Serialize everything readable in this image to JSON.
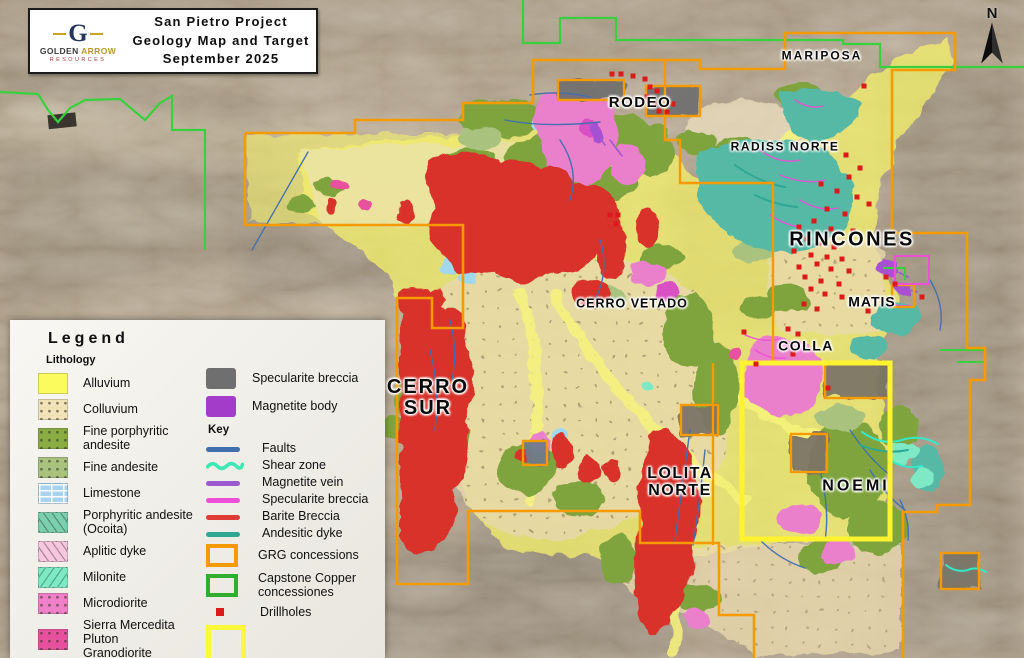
{
  "title_box": {
    "line1": "San Pietro Project",
    "line2": "Geology Map and Target",
    "line3": "September 2025"
  },
  "logo": {
    "monogram": "G",
    "golden": "GOLDEN",
    "arrow": "ARROW",
    "resources": "RESOURCES"
  },
  "north_indicator": {
    "label": "N"
  },
  "legend": {
    "title": "Legend",
    "lithology_heading": "Lithology",
    "lithology": [
      {
        "label": "Alluvium",
        "color": "#fbfb5e",
        "pattern": "solid"
      },
      {
        "label": "Colluvium",
        "color": "#f2e3b9",
        "pattern": "dots"
      },
      {
        "label": "Fine porphyritic\nandesite",
        "color": "#8aab42",
        "pattern": "specks"
      },
      {
        "label": "Fine andesite",
        "color": "#a9c37f",
        "pattern": "specks"
      },
      {
        "label": "Limestone",
        "color": "#a8d3f0",
        "pattern": "bricks"
      },
      {
        "label": "Porphyritic andesite\n(Ocoita)",
        "color": "#7ccfae",
        "pattern": "dashes"
      },
      {
        "label": "Aplitic dyke",
        "color": "#f6c7de",
        "pattern": "dashes"
      },
      {
        "label": "Milonite",
        "color": "#7fe9c6",
        "pattern": "slashes"
      },
      {
        "label": "Microdiorite",
        "color": "#ef7fc7",
        "pattern": "specks"
      },
      {
        "label": "Sierra Mercedita Pluton\nGranodiorite",
        "color": "#e9519f",
        "pattern": "x"
      }
    ],
    "bodies": [
      {
        "label": "Specularite breccia",
        "color": "#6f6f6f"
      },
      {
        "label": "Magnetite body",
        "color": "#a23cc9"
      }
    ],
    "key_heading": "Key",
    "key_lines": [
      {
        "label": "Faults",
        "color": "#3f6fae",
        "style": "line"
      },
      {
        "label": "Shear zone",
        "color": "#3fe9b4",
        "style": "wavy"
      },
      {
        "label": "Magnetite vein",
        "color": "#9b59d0",
        "style": "line"
      },
      {
        "label": "Specularite breccia",
        "color": "#ee4fd8",
        "style": "line"
      },
      {
        "label": "Barite Breccia",
        "color": "#e03c36",
        "style": "line"
      },
      {
        "label": "Andesitic dyke",
        "color": "#2fa893",
        "style": "line"
      }
    ],
    "key_boxes": [
      {
        "label": "GRG concessions",
        "color": "#f59a00"
      },
      {
        "label": "Capstone Copper\nconcessiones",
        "color": "#2fae2f"
      }
    ],
    "drillholes": {
      "label": "Drillholes",
      "color": "#dd1a1a"
    },
    "area_figure": {
      "label": "Area figure 2",
      "color": "#fdf83a"
    }
  },
  "map_labels": [
    {
      "text": "MARIPOSA",
      "x": 822,
      "y": 56,
      "size": 12,
      "ls": 2
    },
    {
      "text": "RODEO",
      "x": 640,
      "y": 103,
      "size": 15,
      "ls": 1.5
    },
    {
      "text": "RADISS NORTE",
      "x": 785,
      "y": 147,
      "size": 12,
      "ls": 1.5
    },
    {
      "text": "RINCONES",
      "x": 852,
      "y": 240,
      "size": 20,
      "ls": 2.5
    },
    {
      "text": "CERRO VETADO",
      "x": 632,
      "y": 304,
      "size": 12.5,
      "ls": 1
    },
    {
      "text": "MATIS",
      "x": 872,
      "y": 302,
      "size": 14,
      "ls": 1
    },
    {
      "text": "COLLA",
      "x": 806,
      "y": 346,
      "size": 14,
      "ls": 1.5
    },
    {
      "text": "CERRO\nSUR",
      "x": 428,
      "y": 398,
      "size": 20,
      "ls": 2
    },
    {
      "text": "LOLITA\nNORTE",
      "x": 680,
      "y": 483,
      "size": 16,
      "ls": 1.5
    },
    {
      "text": "NOEMI",
      "x": 856,
      "y": 487,
      "size": 16,
      "ls": 3
    }
  ],
  "drillhole_points": [
    [
      612,
      74
    ],
    [
      621,
      74
    ],
    [
      633,
      76
    ],
    [
      645,
      79
    ],
    [
      650,
      87
    ],
    [
      657,
      91
    ],
    [
      647,
      97
    ],
    [
      654,
      104
    ],
    [
      659,
      111
    ],
    [
      667,
      112
    ],
    [
      673,
      104
    ],
    [
      610,
      215
    ],
    [
      618,
      215
    ],
    [
      616,
      224
    ],
    [
      864,
      86
    ],
    [
      846,
      155
    ],
    [
      860,
      168
    ],
    [
      849,
      177
    ],
    [
      821,
      184
    ],
    [
      837,
      191
    ],
    [
      857,
      197
    ],
    [
      869,
      204
    ],
    [
      827,
      209
    ],
    [
      845,
      214
    ],
    [
      814,
      221
    ],
    [
      799,
      227
    ],
    [
      831,
      229
    ],
    [
      853,
      231
    ],
    [
      807,
      239
    ],
    [
      819,
      243
    ],
    [
      834,
      247
    ],
    [
      794,
      251
    ],
    [
      811,
      255
    ],
    [
      827,
      257
    ],
    [
      842,
      259
    ],
    [
      817,
      264
    ],
    [
      799,
      267
    ],
    [
      831,
      269
    ],
    [
      849,
      271
    ],
    [
      805,
      277
    ],
    [
      821,
      281
    ],
    [
      839,
      284
    ],
    [
      811,
      289
    ],
    [
      825,
      294
    ],
    [
      842,
      297
    ],
    [
      886,
      277
    ],
    [
      895,
      284
    ],
    [
      804,
      304
    ],
    [
      817,
      309
    ],
    [
      868,
      311
    ],
    [
      922,
      297
    ],
    [
      788,
      329
    ],
    [
      798,
      334
    ],
    [
      744,
      332
    ],
    [
      793,
      354
    ],
    [
      756,
      364
    ],
    [
      828,
      388
    ]
  ],
  "colors": {
    "grg_concessions": "#f59a00",
    "capstone_copper": "#38d13d",
    "area_figure": "#fff22e",
    "drillholes": "#dd1a1a",
    "faults": "#3f6fae",
    "shear_zone": "#3fe9b4",
    "magnetite_vein": "#9b59d0",
    "specularite_line": "#ee4fd8",
    "barite_line": "#e03c36",
    "andesitic_dyke": "#2fa893",
    "alluvium_overlay": "#f2ee6d",
    "colluvium_overlay": "#e8d8ac"
  }
}
